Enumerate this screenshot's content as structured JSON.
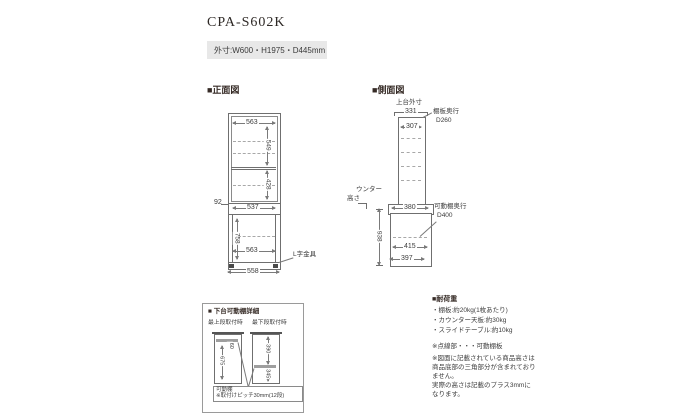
{
  "colors": {
    "heading": "#362b26",
    "line": "#7a7a7a",
    "spec_box_bg": "#e8e8e8"
  },
  "header": {
    "model": "CPA-S602K",
    "outer_dims": "外寸:W600・H1975・D445mm"
  },
  "front": {
    "title": "■正面図",
    "dim_top_width": "563",
    "dim_upper_height": "549",
    "dim_mid_height": "428",
    "dim_counter_gap": "92",
    "dim_counter_width": "537",
    "dim_lower_height": "758",
    "dim_lower_width": "563",
    "dim_base_width": "558",
    "bracket_label": "L字金具"
  },
  "side": {
    "title": "■側面図",
    "upper_outer_label": "上台外寸",
    "dim_upper_outer": "331",
    "dim_upper_inner": "307",
    "shelf_depth_label": "棚板奥行",
    "shelf_depth_value": "D260",
    "counter_height_label_1": "ウンター",
    "counter_height_label_2": "高さ",
    "dim_counter_depth": "380",
    "movable_shelf_label": "可動棚奥行",
    "movable_shelf_value": "D400",
    "dim_counter_height": "938",
    "dim_lower_depth": "415",
    "dim_base_depth": "397"
  },
  "detail": {
    "title": "■ 下台可動棚詳細",
    "col_left": "最上段取付時",
    "col_right": "最下段取付時",
    "dim_left_top": "60",
    "dim_left_height": "675",
    "dim_right_top": "390",
    "dim_right_bottom": "345",
    "note_title": "可動棚",
    "note_text": "※取付けピッチ30mm(12段)"
  },
  "load": {
    "title": "■耐荷重",
    "items": [
      "・棚板:約20kg(1枚あたり)",
      "・カウンター天板:約30kg",
      "・スライドテーブル:約10kg"
    ],
    "legend": "※点線部・・・可動棚板",
    "note_lines": [
      "※図面に記載されている商品高さは",
      "商品底部の三角部分が含まれており",
      "ません。",
      "実際の高さは記載のプラス3mmに",
      "なります。"
    ]
  }
}
